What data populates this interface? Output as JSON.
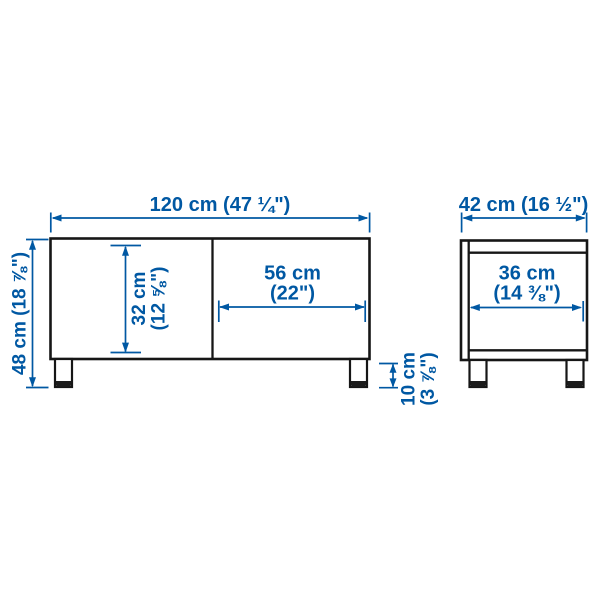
{
  "diagram": {
    "title": "TV bench dimension diagram",
    "accent_color": "#0058a3",
    "line_color": "#161616",
    "views": {
      "front": {
        "overall_width": {
          "label": "120 cm (47 ¼\")",
          "cm": 120,
          "inches": "47 ¼"
        },
        "overall_height": {
          "label": "48 cm (18 ⅞\")",
          "cm": 48,
          "inches": "18 ⅞"
        },
        "compartment_height": {
          "line1": "32 cm",
          "line2": "(12 ⅝\")",
          "cm": 32,
          "inches": "12 ⅝"
        },
        "door_width": {
          "line1": "56 cm",
          "line2": "(22\")",
          "cm": 56,
          "inches": "22"
        },
        "leg_height": {
          "line1": "10 cm",
          "line2": "(3 ⅞\")",
          "cm": 10,
          "inches": "3 ⅞"
        }
      },
      "side": {
        "overall_depth": {
          "label": "42 cm (16 ½\")",
          "cm": 42,
          "inches": "16 ½"
        },
        "inner_depth": {
          "line1": "36 cm",
          "line2": "(14 ⅜\")",
          "cm": 36,
          "inches": "14 ⅜"
        }
      }
    }
  }
}
